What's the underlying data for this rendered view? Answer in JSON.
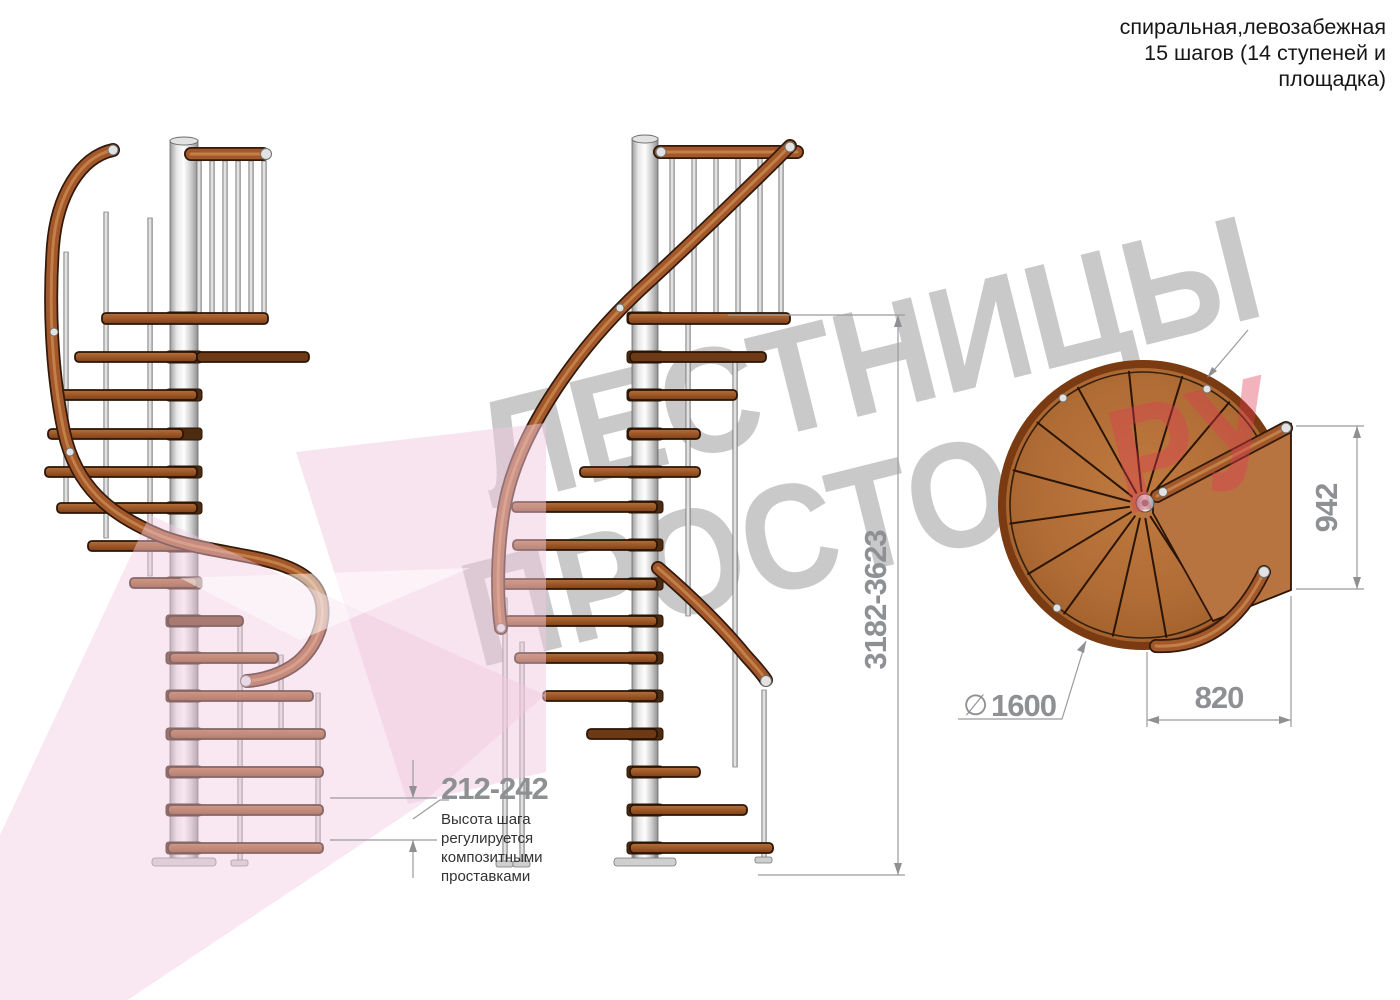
{
  "header": {
    "lines": [
      "спиральная,левозабежная",
      "15 шагов (14 ступеней и",
      "площадка)"
    ]
  },
  "watermark": {
    "word_top": "ЛЕСТНИЦЫ",
    "word_bottom": "ПРОСТО",
    "word_suffix": "РУ",
    "gray": "#c9c9c9",
    "pink": "#f2cadf",
    "red": "#e03a55"
  },
  "dimensions": {
    "total_height": "3182-3623",
    "step_height": "212-242",
    "step_height_note": [
      "Высота шага",
      "регулируется",
      "композитными",
      "проставками"
    ],
    "landing_depth": "942",
    "landing_width": "820",
    "diameter_symbol": "∅",
    "diameter_value": "1600"
  },
  "materials": {
    "wood": "#a2582a",
    "wood_dark": "#6e3a16",
    "steel": "#d9d9d9",
    "dimension_gray": "#8e9094"
  }
}
